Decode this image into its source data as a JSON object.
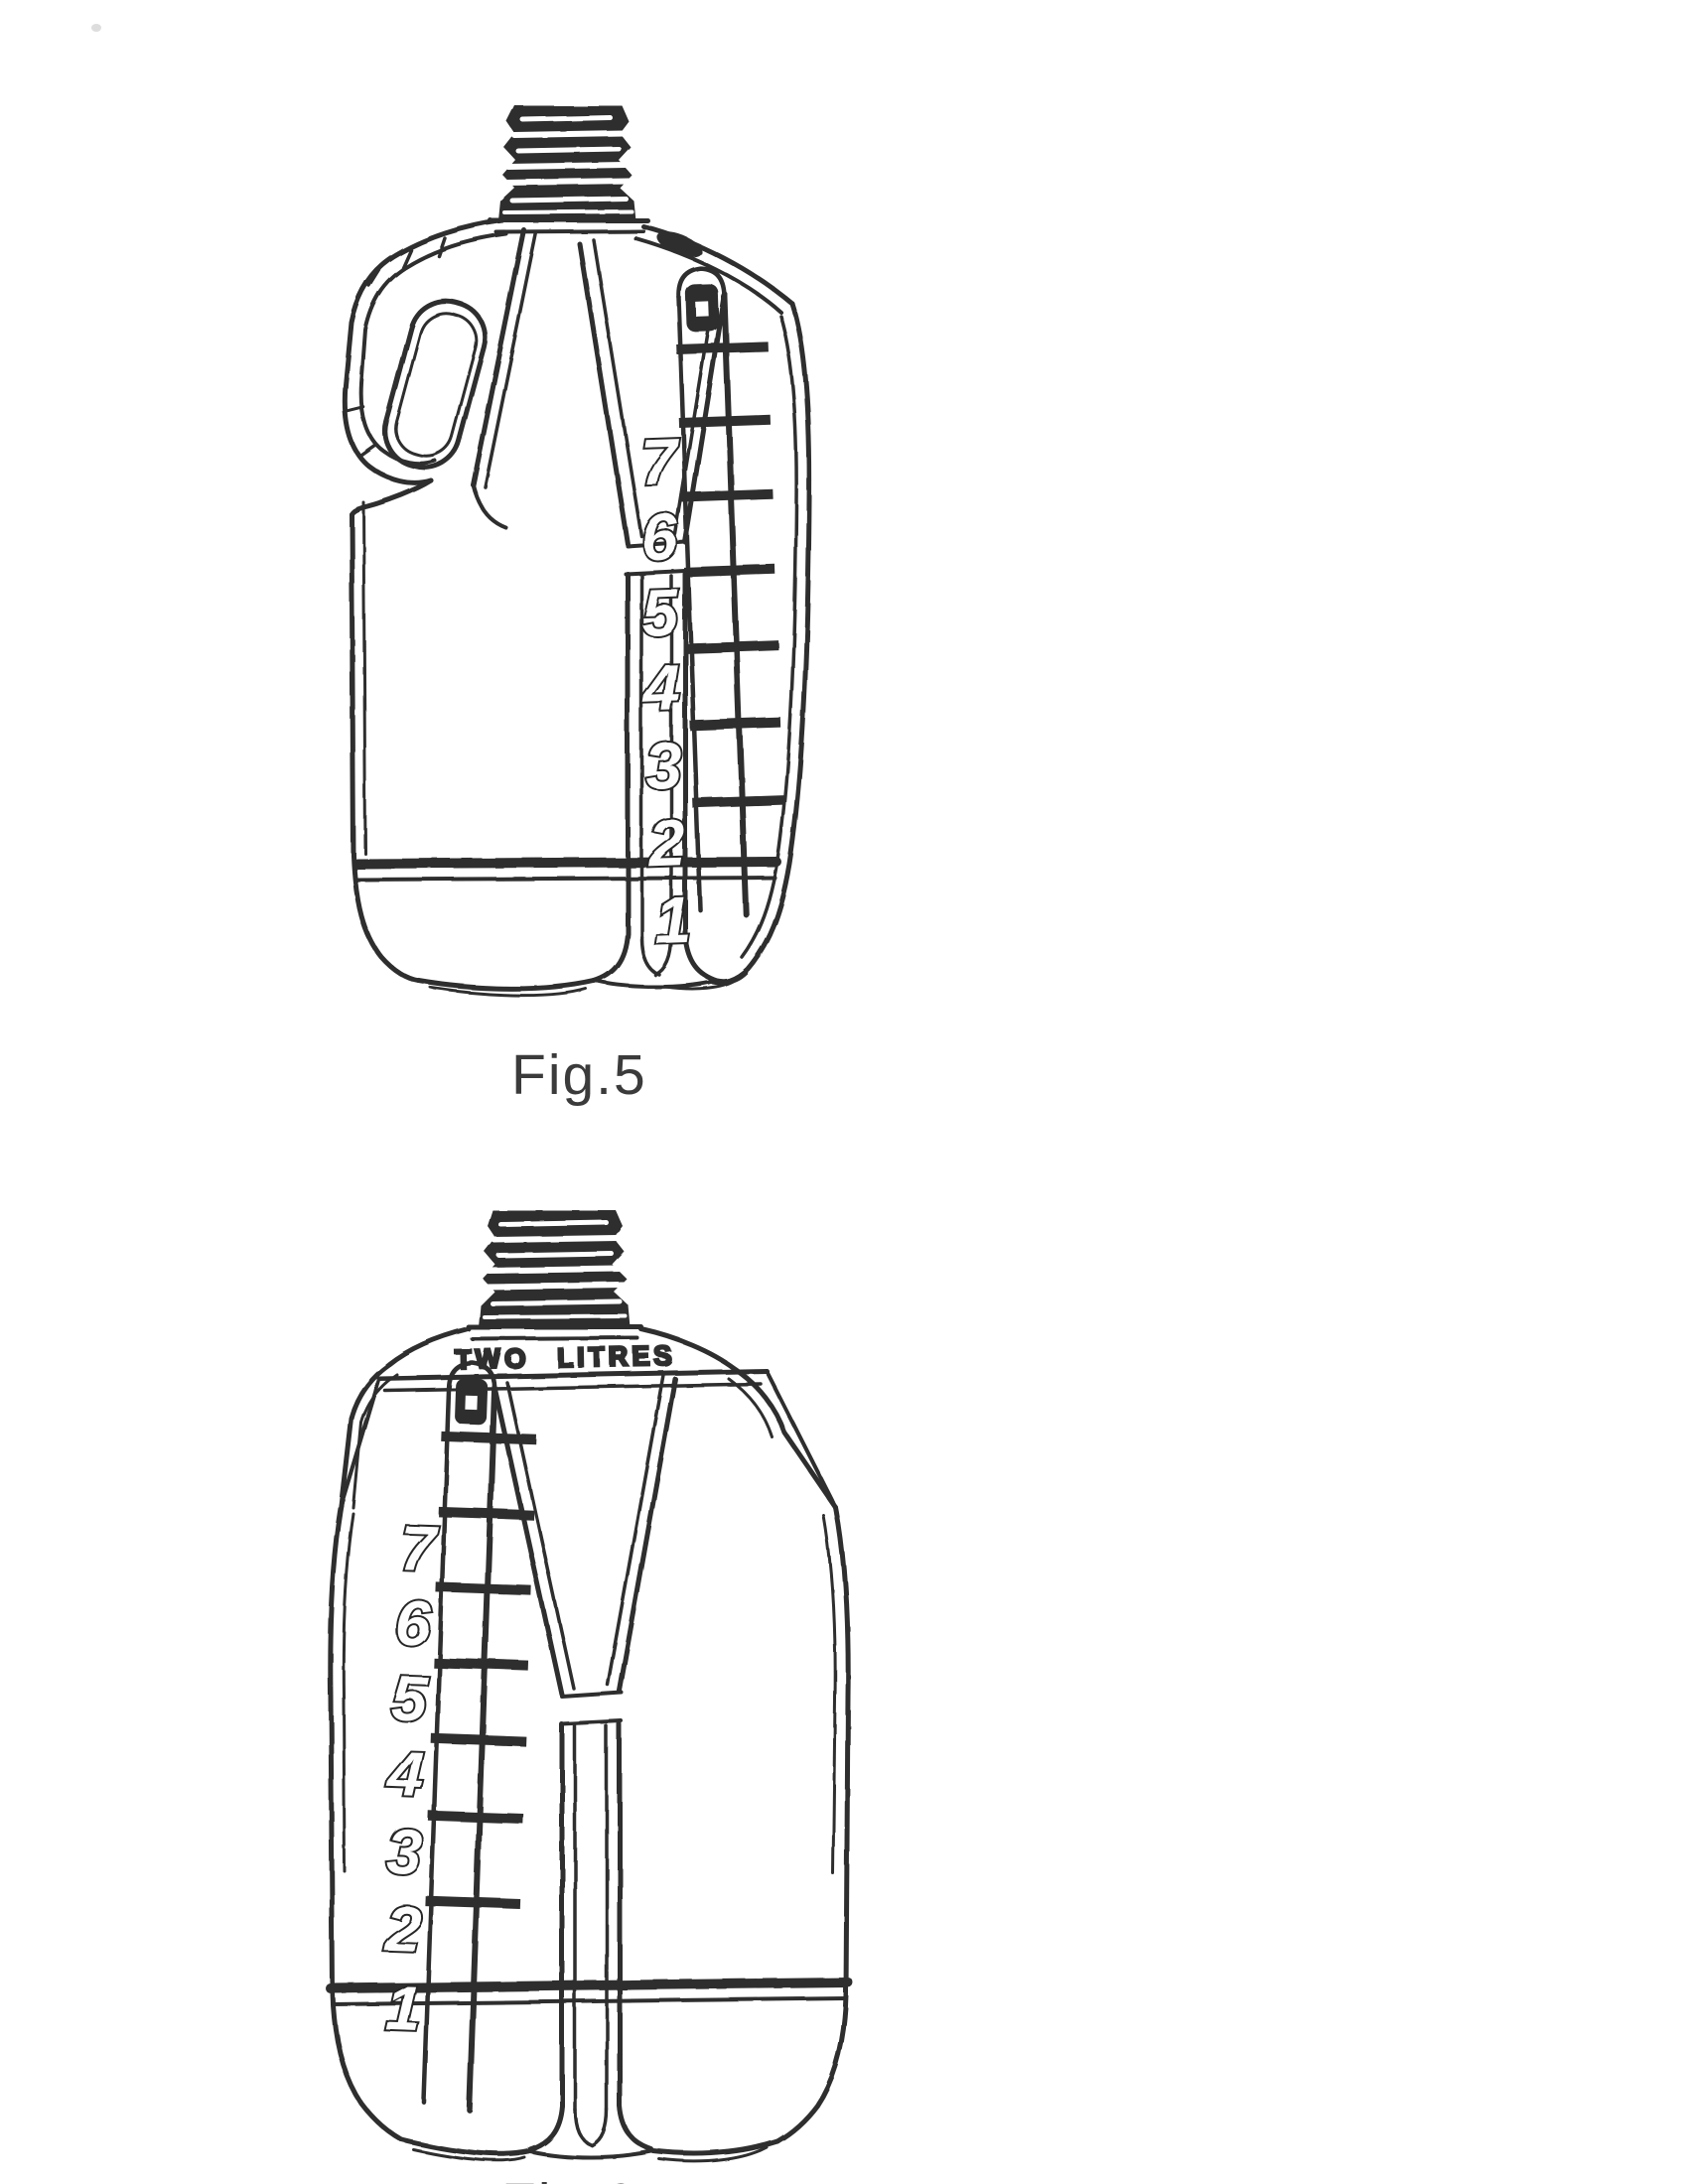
{
  "page": {
    "paper_color": "#ffffff",
    "ink_color": "#2e2e2e"
  },
  "figures": [
    {
      "caption": "Fig.5",
      "scale_numbers": [
        "7",
        "6",
        "5",
        "4",
        "3",
        "2",
        "1"
      ]
    },
    {
      "caption": "Fig.6",
      "embossed_text": "TWO LITRES",
      "scale_numbers": [
        "7",
        "6",
        "5",
        "4",
        "3",
        "2",
        "1"
      ]
    }
  ]
}
